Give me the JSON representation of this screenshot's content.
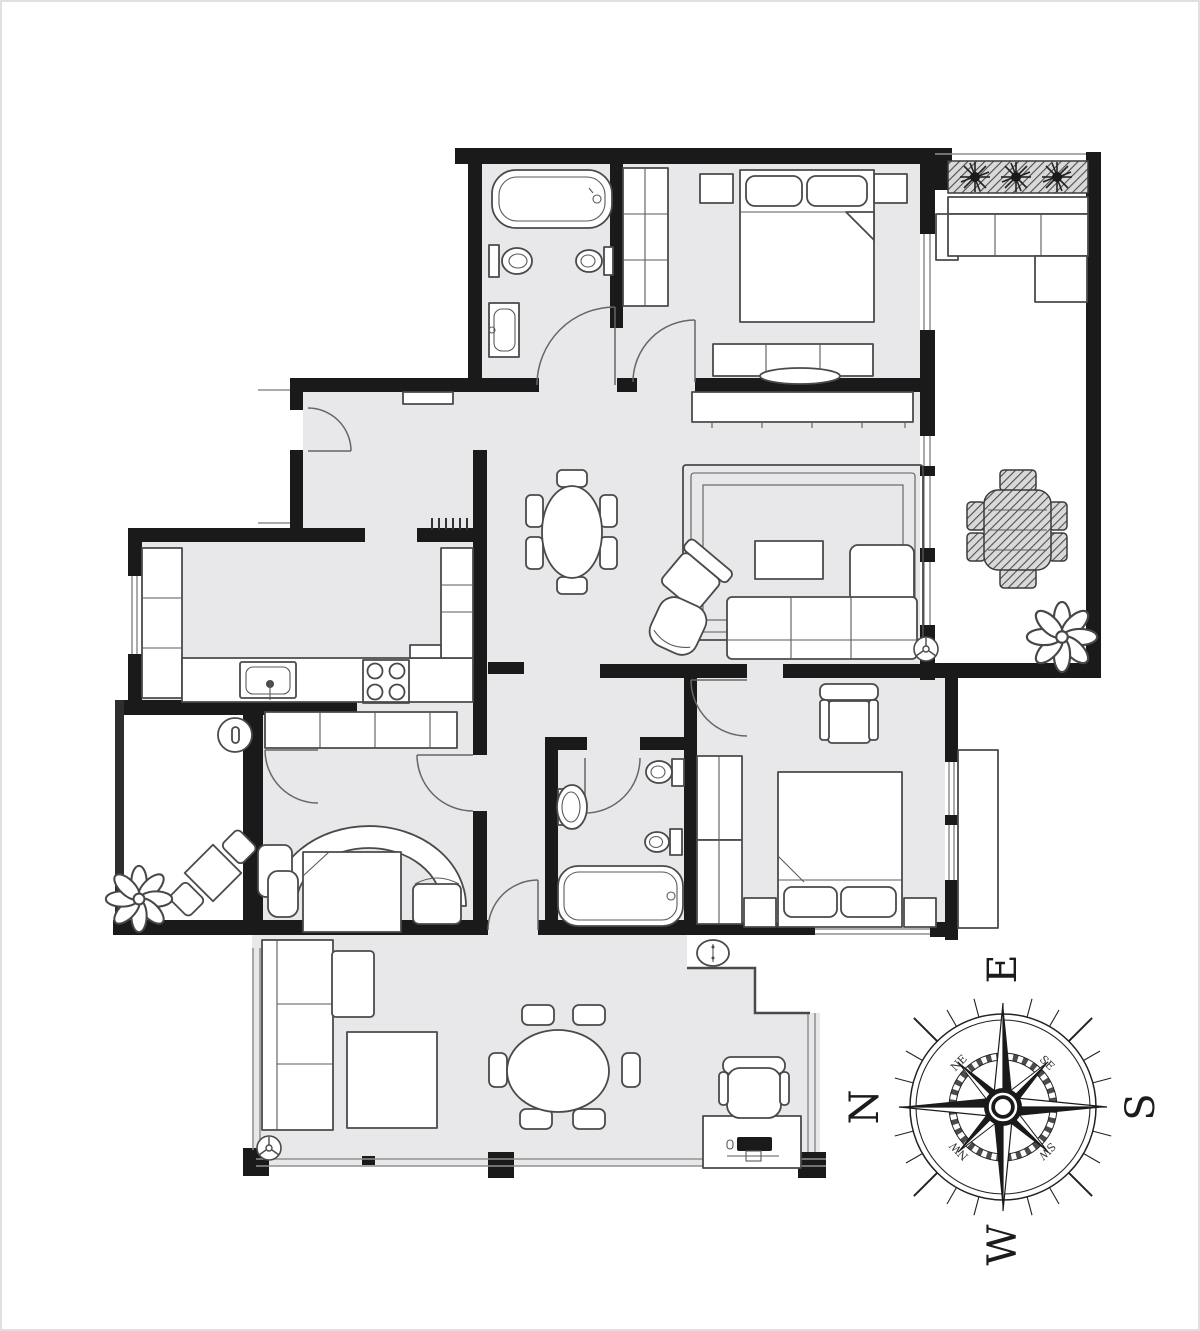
{
  "compass": {
    "cardinals": {
      "n": "N",
      "e": "E",
      "s": "S",
      "w": "W"
    },
    "intercardinals": {
      "ne": "NE",
      "se": "SE",
      "sw": "SW",
      "nw": "NW"
    }
  },
  "palette": {
    "wall": "#1a1a1a",
    "floor": "#e8e8ea",
    "furniture_line": "#4a4a4a",
    "glass_line": "#8f8f8f",
    "paper": "#ffffff"
  },
  "icons": {
    "compass-rose-icon": "8-point star with ring and tick marks, rotated 90deg CCW (N left, E up)",
    "plant-icon": "petal rosette flower",
    "planter-icon": "hatched box with three shrub bursts",
    "ceiling-fan-icon": "small circle with three spokes",
    "washing-machine-icon": "oval with dial",
    "stove-icon": "four burner circles",
    "sink-icon": "basin with faucet dot"
  }
}
